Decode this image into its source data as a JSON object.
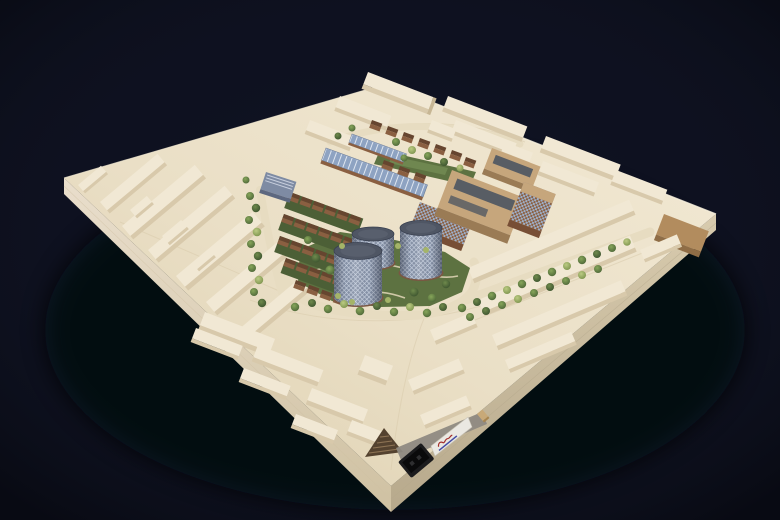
{
  "meta": {
    "subject": "photograph of a wooden architectural site model on a dark backdrop",
    "background": "#0e1120"
  },
  "model": {
    "baseboard": {
      "top": "#eadfc6",
      "edge_left_face": "#ddd0b2",
      "edge_right_face": "#c9bb9e"
    },
    "context": {
      "block_top": "#f1e8d4",
      "block_side": "#d8c9ab",
      "block_end": "#c7b694",
      "corner_stained_block": "#b28c5e"
    },
    "site": {
      "lawn": "#5d7241",
      "garden_strip": "#4c5f36",
      "brick_wall": "#8a5f41",
      "brick_roof": "#66452f",
      "pv_roof": "#8ea3c2",
      "pv_frame": "#e8edf5",
      "retained_building": "#7e8ba3",
      "plywood_roof": "#c6a67c",
      "plywood_wall": "#9a7b55",
      "roof_panel": "#585d64",
      "checker_accent": "#9fb0c9",
      "tower_body": "#8793a8",
      "tower_top": "#4f5664",
      "tower_base": "#7a5743",
      "tree_dark": "#46603a",
      "tree_mid": "#5f7f46",
      "tree_light": "#7f9c55",
      "shrub": "#a4b468"
    },
    "fixtures": {
      "plaque_bg": "#eae8e2",
      "plaque_logo_color": "#a32f2c",
      "plaque_text_color": "#27339b",
      "plaque_text_legible": "",
      "socket": "#1b1b1d",
      "knob": "#c8a978",
      "pyramid_dark": "#54422f",
      "pyramid_stripe": "#8d7354"
    },
    "inventory": {
      "gasholder_towers": 3,
      "brick_house_rows": 5,
      "context_zones": [
        "left",
        "top",
        "right",
        "bottom"
      ]
    }
  }
}
